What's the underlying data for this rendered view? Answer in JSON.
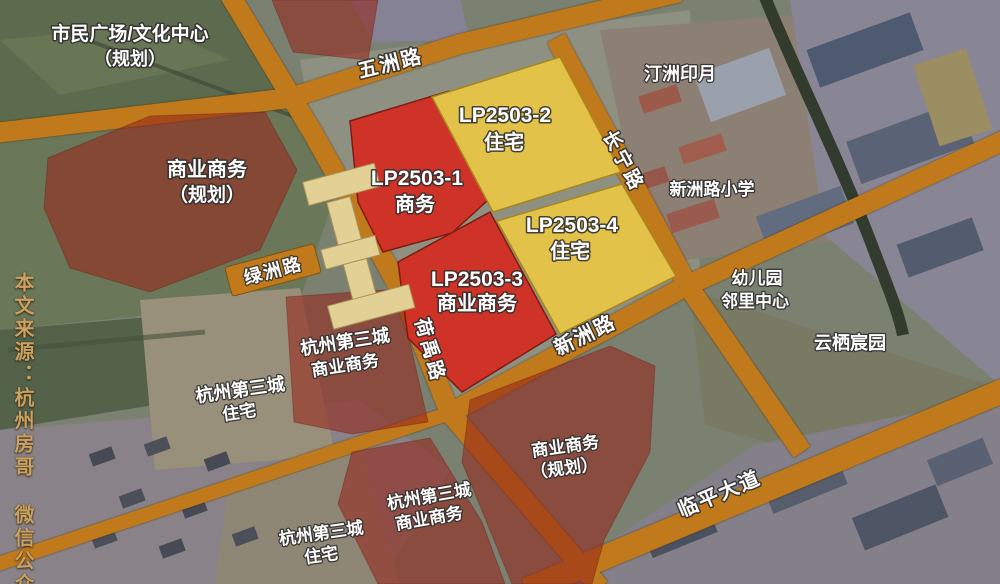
{
  "watermark": "本文来源：杭州房哥 微信公众号",
  "colors": {
    "road": "#c0791b",
    "road_edge": "#8a5a10",
    "plot_red": "#d23026",
    "plot_red_edge": "#7e180f",
    "plot_yellow": "#e6c448",
    "plot_yellow_edge": "#a8871c",
    "overlay_red": "rgba(150,38,26,0.58)",
    "overlay_red_edge": "rgba(110,24,14,0.35)",
    "building": "#e2d094",
    "building_edge": "#a8925a",
    "watermark_gold": "#c9a262",
    "canal": "#2d3828"
  },
  "roads": {
    "wuzhou": "五洲路",
    "changning": "长宁路",
    "lvzhou": "绿洲路",
    "heyu": "荷禹路",
    "xinzhou": "新洲路",
    "linping": "临平大道"
  },
  "plots": {
    "p1": {
      "id": "LP2503-1",
      "use": "商务"
    },
    "p2": {
      "id": "LP2503-2",
      "use": "住宅"
    },
    "p3": {
      "id": "LP2503-3",
      "use": "商业商务"
    },
    "p4": {
      "id": "LP2503-4",
      "use": "住宅"
    }
  },
  "labels": {
    "civic": {
      "line1": "市民广场/文化中心",
      "line2": "（规划）"
    },
    "tingzhou": {
      "line1": "汀洲印月"
    },
    "biz_nw": {
      "line1": "商业商务",
      "line2": "（规划）"
    },
    "school": {
      "line1": "新洲路小学"
    },
    "kindergarten": {
      "line1": "幼儿园",
      "line2": "邻里中心"
    },
    "yunqi": {
      "line1": "云栖宸园"
    },
    "c3_biz_mid": {
      "line1": "杭州第三城",
      "line2": "商业商务"
    },
    "c3_res_mid": {
      "line1": "杭州第三城",
      "line2": "住宅"
    },
    "c3_biz_bottom": {
      "line1": "杭州第三城",
      "line2": "商业商务"
    },
    "c3_res_bottom": {
      "line1": "杭州第三城",
      "line2": "住宅"
    },
    "biz_se": {
      "line1": "商业商务",
      "line2": "（规划）"
    }
  }
}
